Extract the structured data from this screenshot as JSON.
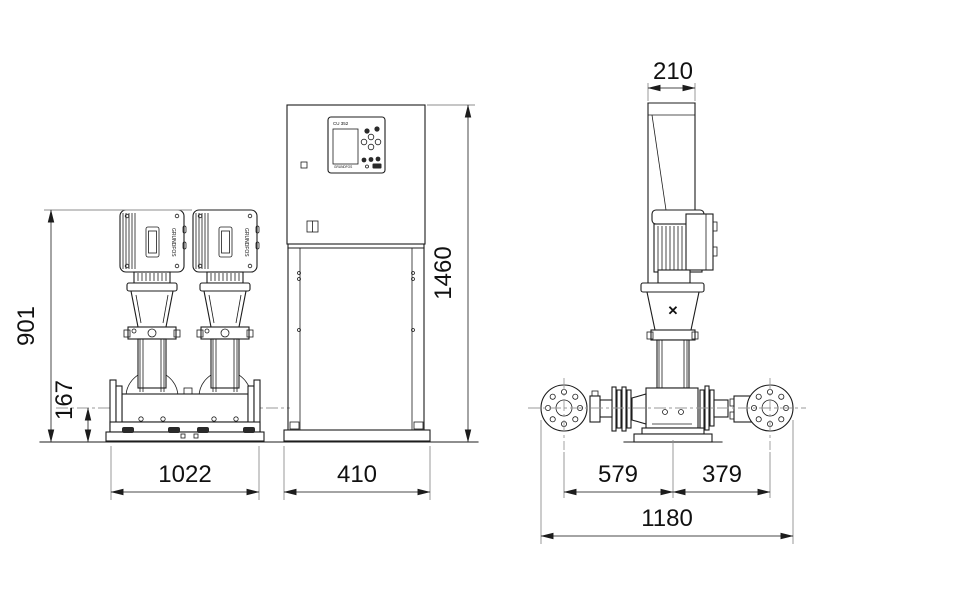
{
  "drawing": {
    "brand": "GRUNDFOS",
    "controller": {
      "label": "CU 352"
    },
    "icons": {
      "grundfos_mark": "✕"
    },
    "colors": {
      "line": "#1c1c1c",
      "dimension_line": "#4a4a4a",
      "centerline": "#9a9a9a",
      "background": "#ffffff",
      "text": "#111111"
    },
    "dimensions": {
      "front": {
        "height": "901",
        "pipe_center_height": "167",
        "width": "1022"
      },
      "cabinet": {
        "height": "1460",
        "width": "410"
      },
      "side": {
        "depth_cabinet": "210",
        "suction_to_center": "579",
        "center_to_discharge": "379",
        "overall": "1180"
      }
    }
  }
}
